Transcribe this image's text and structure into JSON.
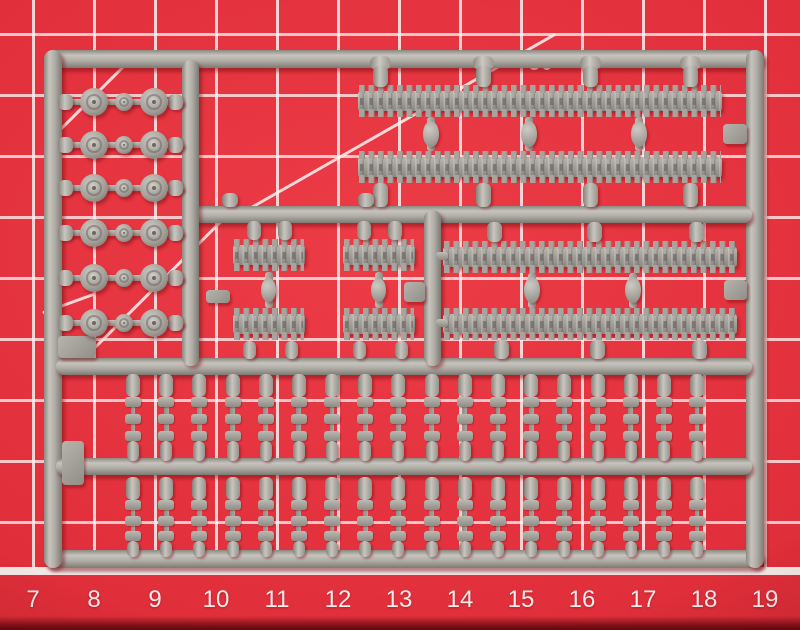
{
  "mat": {
    "angle_label": "30",
    "ruler_numbers": [
      "7",
      "8",
      "9",
      "10",
      "11",
      "12",
      "13",
      "14",
      "15",
      "16",
      "17",
      "18",
      "19"
    ],
    "colors": {
      "surface": "#e02f3b",
      "grid_line": "#fcf0ef",
      "ruler_text": "#f4ecec",
      "baseline": "#f2e8e7",
      "edge_shadow": "#7c1016"
    }
  },
  "sprue": {
    "material_color": "#a9a59e",
    "highlight_color": "#c7c3bd",
    "shadow_color": "#7d7973",
    "parts": {
      "road_wheel_rows": 6,
      "large_wheels_per_row": 2,
      "small_wheels_per_row": 1,
      "long_track_lengths": 4,
      "short_track_lengths": 4,
      "small_link_columns_per_row": 18,
      "small_link_rows": 2,
      "molding_tabs": 6
    }
  }
}
